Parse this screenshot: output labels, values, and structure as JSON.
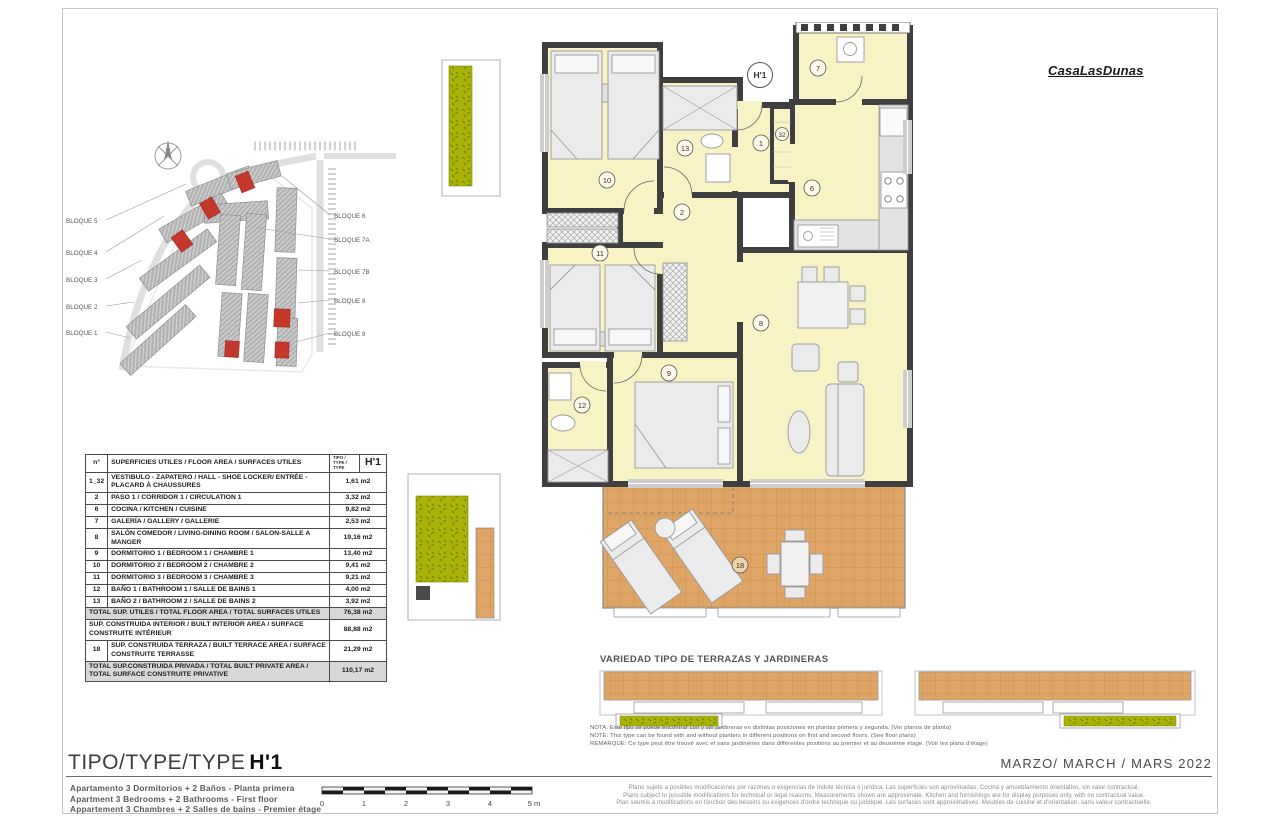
{
  "page": {
    "brand": "CasaLasDunas"
  },
  "colors": {
    "wall": "#3f3f3f",
    "room_fill": "#f8f3c5",
    "terrace_tile": "#dfa567",
    "planter_green": "#a9b307",
    "highlight_red": "#c4382c",
    "table_total_bg": "#d8d8d8"
  },
  "site_plan": {
    "left_labels": [
      "BLOQUE 5",
      "BLOQUE 4",
      "BLOQUE 3",
      "BLOQUE 2",
      "BLOQUE 1"
    ],
    "right_labels": [
      "BLOQUE 6",
      "BLOQUE 7A",
      "BLOQUE 7B",
      "BLOQUE 8",
      "BLOQUE 9"
    ]
  },
  "floor_plan": {
    "unit_label": "H'1",
    "rooms": {
      "hall": "1",
      "corridor": "2",
      "kitchen": "6",
      "gallery": "7",
      "living": "8",
      "bedroom1": "9",
      "bedroom2": "10",
      "bedroom3": "11",
      "bathroom1": "12",
      "bathroom2": "13",
      "terrace": "18",
      "shoe_locker": "32"
    }
  },
  "area_table": {
    "header": {
      "num": "n°",
      "desc": "SUPERFICIES UTILES / FLOOR AREA / SURFACES UTILES",
      "tipo": "TIPO / TYPE / TYPE",
      "code": "H'1"
    },
    "rows": [
      {
        "num": "1_32",
        "desc": "VESTIBULO - ZAPATERO / HALL - SHOE LOCKER/ ENTRÉE - PLACARD À CHAUSSURES",
        "val": "1,61 m2"
      },
      {
        "num": "2",
        "desc": "PASO 1 / CORRIDOR 1 / CIRCULATION 1",
        "val": "3,32 m2"
      },
      {
        "num": "6",
        "desc": "COCINA / KITCHEN / CUISINE",
        "val": "9,82 m2"
      },
      {
        "num": "7",
        "desc": "GALERÍA / GALLERY / GALLERIE",
        "val": "2,53 m2"
      },
      {
        "num": "8",
        "desc": "SALÓN COMEDOR / LIVING-DINING ROOM / SALON-SALLE A MANGER",
        "val": "19,16 m2"
      },
      {
        "num": "9",
        "desc": "DORMITORIO 1 / BEDROOM 1 / CHAMBRE 1",
        "val": "13,40 m2"
      },
      {
        "num": "10",
        "desc": "DORMITORIO 2 / BEDROOM 2 / CHAMBRE 2",
        "val": "9,41 m2"
      },
      {
        "num": "11",
        "desc": "DORMITORIO 3 / BEDROOM 3 / CHAMBRE 3",
        "val": "9,21 m2"
      },
      {
        "num": "12",
        "desc": "BAÑO 1 / BATHROOM 1 / SALLE DE BAINS 1",
        "val": "4,00 m2"
      },
      {
        "num": "13",
        "desc": "BAÑO 2 / BATHROOM 2 / SALLE DE BAINS 2",
        "val": "3,92 m2"
      },
      {
        "num": "",
        "desc": "TOTAL SUP. UTILES / TOTAL FLOOR AREA / TOTAL SURFACES UTILES",
        "val": "76,38 m2"
      },
      {
        "num": "",
        "desc": "SUP. CONSTRUIDA INTERIOR / BUILT INTERIOR AREA / SURFACE CONSTRUITE INTÉRIEUR",
        "val": "88,88 m2"
      },
      {
        "num": "18",
        "desc": "SUP. CONSTRUIDA TERRAZA / BUILT TERRACE AREA / SURFACE CONSTRUITE TERRASSE",
        "val": "21,29 m2"
      },
      {
        "num": "",
        "desc": "TOTAL SUP.CONSTRUIDA PRIVADA / TOTAL BUILT PRIVATE AREA / TOTAL SURFACE CONSTRUITE PRIVATIVE",
        "val": "110,17 m2"
      }
    ]
  },
  "terrace_variants": {
    "title": "VARIEDAD TIPO DE TERRAZAS Y JARDINERAS"
  },
  "notes": {
    "lines": [
      "NOTA: Este tipo se puede encontrar con y sin jardineras en distintas posiciones en plantas primera y segunda. (Ver planos de planta)",
      "NOTE: This type can be found with and without planters in different positions on first and second floors. (See floor plans)",
      "REMARQUE: Ce type peut être trouvé avec et sans jardinières dans différentes positions au premier et au deuxième étage. (Voir les plans d'étage)"
    ]
  },
  "title_block": {
    "title_prefix": "TIPO/TYPE/TYPE",
    "title_code": "H'1",
    "subtitles": [
      "Apartamento 3 Dormitorios + 2 Baños - Planta primera",
      "Apartment 3 Bedrooms + 2 Bathrooms - First floor",
      "Appartement 3 Chambres + 2 Salles de bains - Premier étage"
    ],
    "scale_ticks": [
      "0",
      "1",
      "2",
      "3",
      "4",
      "5 m"
    ],
    "date_label": "MARZO/ MARCH / MARS 2022",
    "disclaimer": [
      "Plano sujeto a posibles modificaciones por razones o exigencias de índole técnica o jurídica. Las superficies son aproximadas. Cocina y amueblamiento orientativo, sin valor contractual.",
      "Plans subject to possible modifications for technical or legal reasons. Measurements shown are approximate. Kitchen and furnishings are for display purposes only, with no contractual value.",
      "Plan soumis à modifications en fonction des besoins ou exigences d'ordre technique ou juridique. Les surfaces sont approximatives. Meubles de cuisine et d'orientation, sans valeur contractuelle."
    ]
  }
}
